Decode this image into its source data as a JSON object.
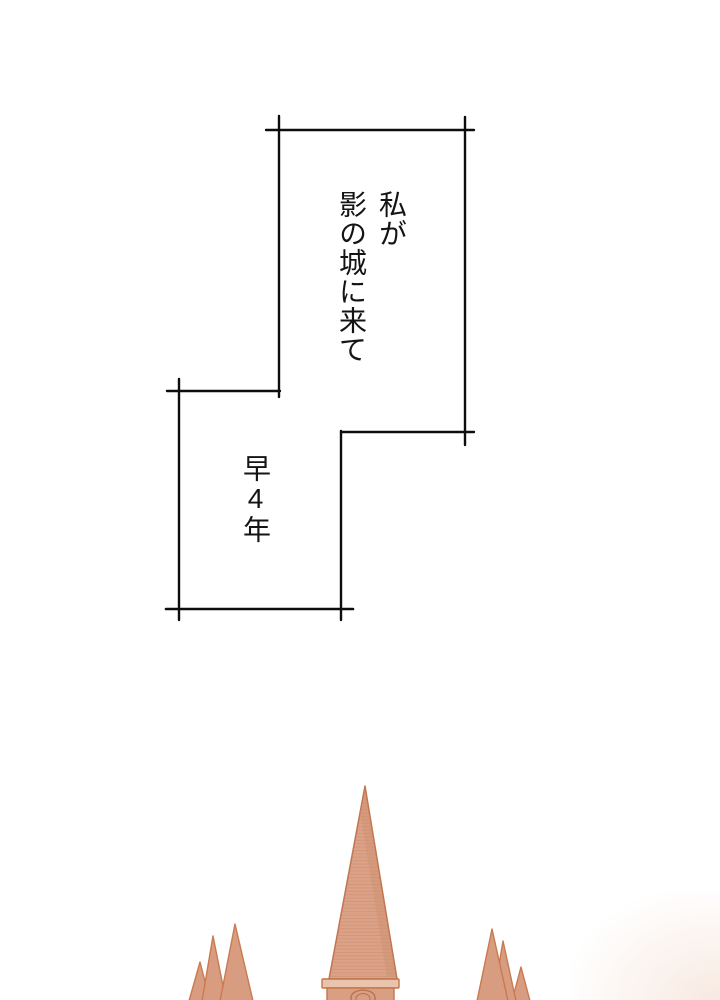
{
  "page": {
    "background_color": "#ffffff",
    "type": "manga-page"
  },
  "narration": {
    "border_color": "#0d0d0d",
    "text_color": "#141414",
    "panel1": {
      "line1": "私が",
      "line2": "影の城に来て"
    },
    "panel2": {
      "text": "早4年"
    }
  },
  "castle": {
    "label": "castle-spires-illustration",
    "spire_fill": "#dba287",
    "spire_texture": "#c08266",
    "spire_shade": "#cf9071",
    "outline": "#c1754c",
    "cornice_fill": "#eac3ac",
    "body_fill": "#d99f82",
    "window_line": "#b96f49",
    "cluster_fill": "#d89c80",
    "cluster_outline": "#c97a50",
    "haze_color": "#f3dbcd"
  }
}
